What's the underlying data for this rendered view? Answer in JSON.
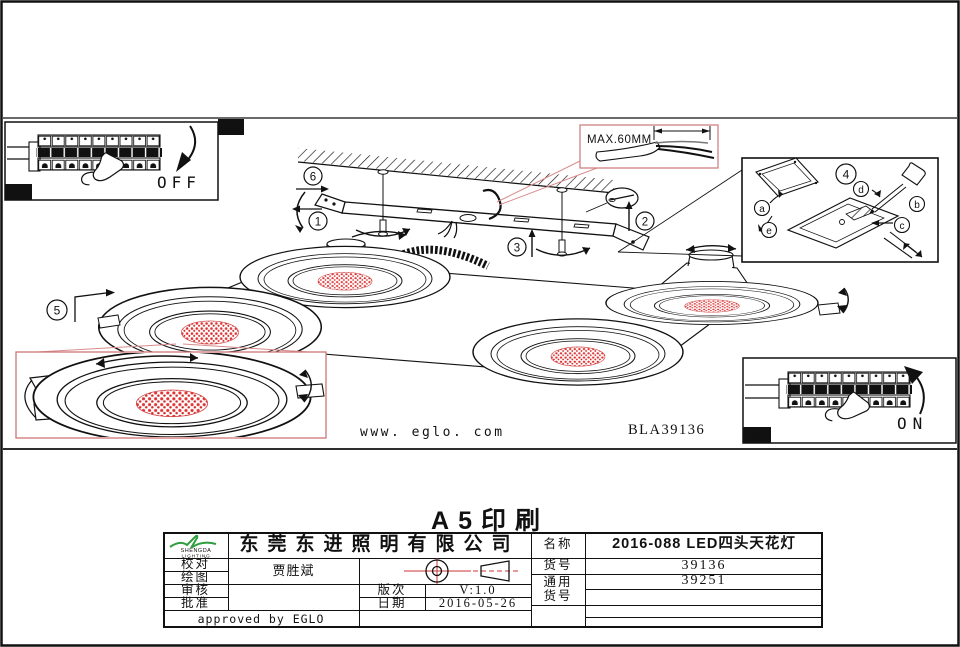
{
  "sheet": {
    "print_title": "A5印刷",
    "website": "www. eglo. com",
    "model_code": "BLA39136"
  },
  "panels": {
    "a": {
      "letter": "A",
      "state": "OFF"
    },
    "b": {
      "letter": "B",
      "max_note": "MAX.60MM"
    },
    "c": {
      "letter": "C",
      "state": "ON"
    }
  },
  "steps": {
    "s1": "1",
    "s2": "2",
    "s3": "3",
    "s4": "4",
    "s5": "5",
    "s6": "6"
  },
  "wiring": {
    "a": "a",
    "b": "b",
    "c": "c",
    "d": "d",
    "e": "e"
  },
  "title_block": {
    "logo_brand": "SHENGDA",
    "logo_sub": "LIGHTING",
    "company": "东莞东进照明有限公司",
    "row_labels": [
      "校对",
      "绘图",
      "审核",
      "批准"
    ],
    "drafter": "贾胜斌",
    "revision_label": "版次",
    "revision": "V:1.0",
    "date_label": "日期",
    "date": "2016-05-26",
    "approved": "approved by EGLO",
    "name_label": "名称",
    "product_name": "2016-088 LED四头天花灯",
    "item_label": "货号",
    "item_no": "39136",
    "common_label_line1": "通用",
    "common_label_line2": "货号",
    "common_no": "39251"
  },
  "colors": {
    "accent_red": "#cc4444",
    "led_red": "#e23333",
    "leader_pink": "#d98c8c"
  }
}
